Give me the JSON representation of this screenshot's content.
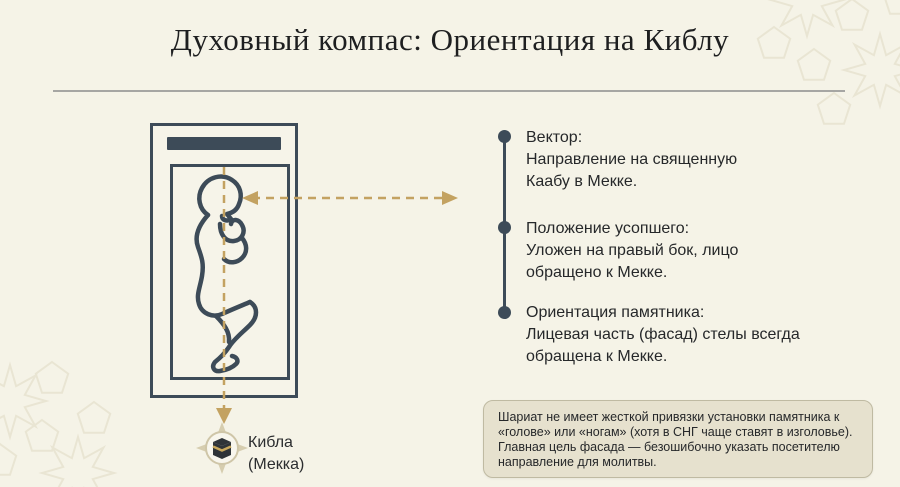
{
  "header": {
    "title": "Духовный компас: Ориентация на Киблу"
  },
  "diagram": {
    "qibla_label_line1": "Кибла",
    "qibla_label_line2": "(Мекка)"
  },
  "timeline": {
    "items": [
      {
        "title": "Вектор:",
        "body": "Направление на священную\nКаабу в Мекке."
      },
      {
        "title": "Положение усопшего:",
        "body": "Уложен на правый бок, лицо\nобращено к Мекке."
      },
      {
        "title": "Ориентация памятника:",
        "body": "Лицевая часть (фасад) стелы всегда\nобращена к Мекке."
      }
    ]
  },
  "footer": {
    "note": "Шариат не имеет жесткой привязки установки памятника к\n«голове» или «ногам» (хотя в СНГ чаще ставят в изголовье).\nГлавная цель фасада — безошибочно указать посетителю\nнаправление для молитвы."
  },
  "colors": {
    "background": "#f5f3e7",
    "slate": "#3d4b58",
    "gold": "#c3a261",
    "note_background": "#e6e1ce",
    "note_border": "#bfbaa2"
  }
}
